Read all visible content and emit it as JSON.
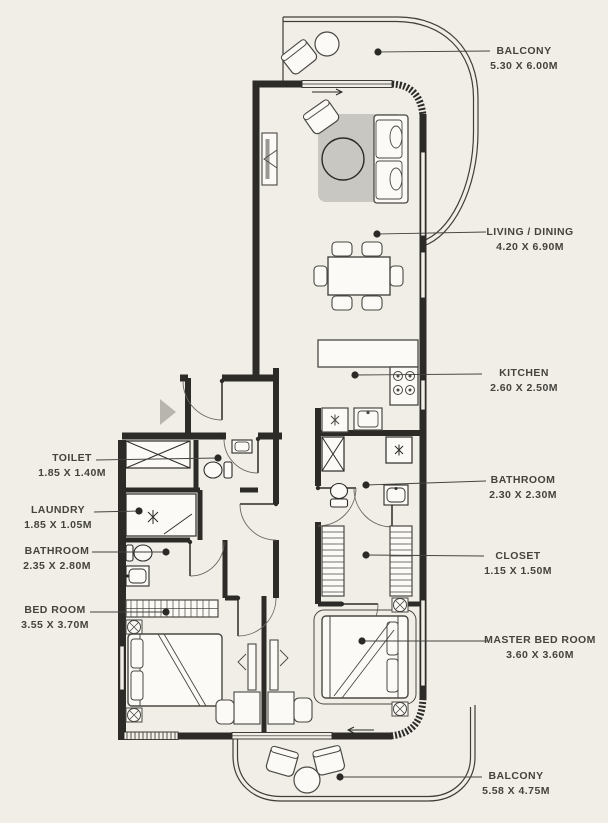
{
  "plan": {
    "background_color": "#f0eee7",
    "wall_color": "#2d2b27",
    "label_color": "#45433d",
    "labels": [
      {
        "id": "balcony-top",
        "name": "BALCONY",
        "dims": "5.30 X 6.00M"
      },
      {
        "id": "living-dining",
        "name": "LIVING / DINING",
        "dims": "4.20 X 6.90M"
      },
      {
        "id": "kitchen",
        "name": "KITCHEN",
        "dims": "2.60 X 2.50M"
      },
      {
        "id": "toilet",
        "name": "TOILET",
        "dims": "1.85 X 1.40M"
      },
      {
        "id": "laundry",
        "name": "LAUNDRY",
        "dims": "1.85 X 1.05M"
      },
      {
        "id": "bathroom",
        "name": "BATHROOM",
        "dims": "2.35 X 2.80M"
      },
      {
        "id": "bedroom",
        "name": "BED ROOM",
        "dims": "3.55 X 3.70M"
      },
      {
        "id": "bathroom-2",
        "name": "BATHROOM",
        "dims": "2.30 X 2.30M"
      },
      {
        "id": "closet",
        "name": "CLOSET",
        "dims": "1.15 X 1.50M"
      },
      {
        "id": "master-bedroom",
        "name": "MASTER BED ROOM",
        "dims": "3.60 X 3.60M"
      },
      {
        "id": "balcony-bottom",
        "name": "BALCONY",
        "dims": "5.58 X 4.75M"
      }
    ],
    "icons": {
      "entry_arrow": "triangle-right",
      "leader_dot": "filled-circle",
      "appliance_asterisk": "six-point-star",
      "shaft_cross": "x-box"
    }
  }
}
